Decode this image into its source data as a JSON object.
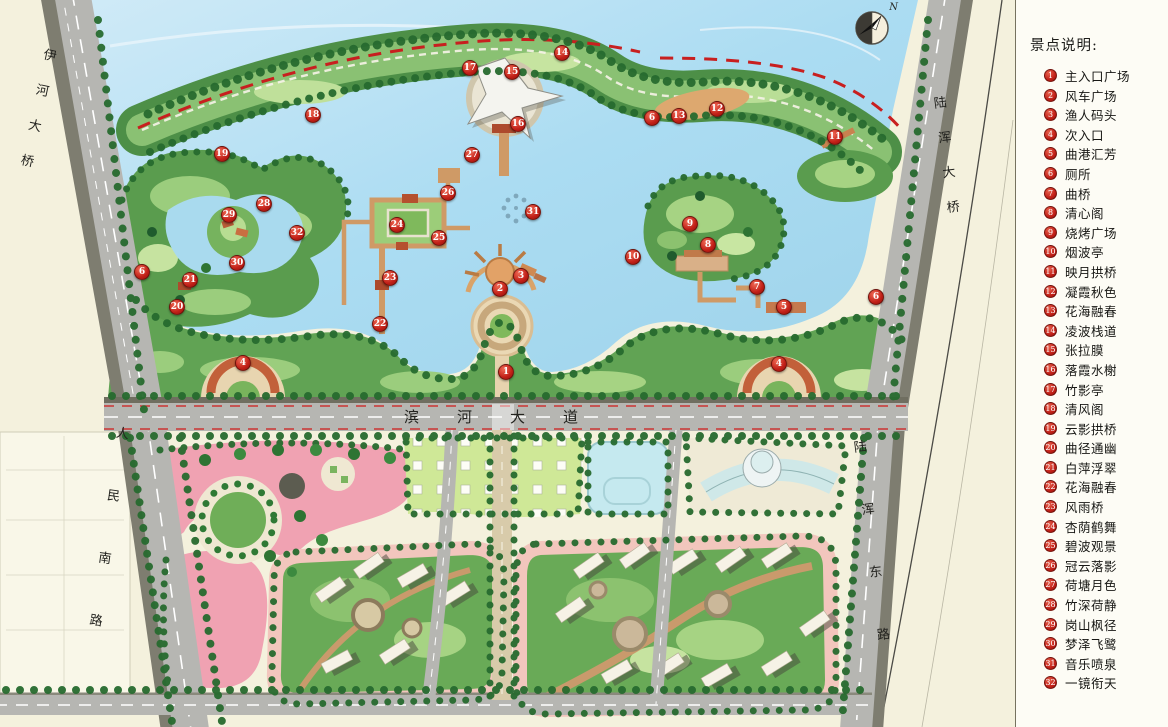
{
  "legend": {
    "title": "景点说明:",
    "items": [
      {
        "n": "1",
        "label": "主入口广场"
      },
      {
        "n": "2",
        "label": "风车广场"
      },
      {
        "n": "3",
        "label": "渔人码头"
      },
      {
        "n": "4",
        "label": "次入口"
      },
      {
        "n": "5",
        "label": "曲港汇芳"
      },
      {
        "n": "6",
        "label": "厕所"
      },
      {
        "n": "7",
        "label": "曲桥"
      },
      {
        "n": "8",
        "label": "清心阁"
      },
      {
        "n": "9",
        "label": "烧烤广场"
      },
      {
        "n": "10",
        "label": "烟波亭"
      },
      {
        "n": "11",
        "label": "映月拱桥"
      },
      {
        "n": "12",
        "label": "凝霞秋色"
      },
      {
        "n": "13",
        "label": "花海融春"
      },
      {
        "n": "14",
        "label": "凌波栈道"
      },
      {
        "n": "15",
        "label": "张拉膜"
      },
      {
        "n": "16",
        "label": "落霞水榭"
      },
      {
        "n": "17",
        "label": "竹影亭"
      },
      {
        "n": "18",
        "label": "清风阁"
      },
      {
        "n": "19",
        "label": "云影拱桥"
      },
      {
        "n": "20",
        "label": "曲径通幽"
      },
      {
        "n": "21",
        "label": "白萍浮翠"
      },
      {
        "n": "22",
        "label": "花海融春"
      },
      {
        "n": "23",
        "label": "风雨桥"
      },
      {
        "n": "24",
        "label": "杏荫鹤舞"
      },
      {
        "n": "25",
        "label": "碧波观景"
      },
      {
        "n": "26",
        "label": "冠云落影"
      },
      {
        "n": "27",
        "label": "荷塘月色"
      },
      {
        "n": "28",
        "label": "竹深荷静"
      },
      {
        "n": "29",
        "label": "岗山枫径"
      },
      {
        "n": "30",
        "label": "梦泽飞鹭"
      },
      {
        "n": "31",
        "label": "音乐喷泉"
      },
      {
        "n": "32",
        "label": "一镜衔天"
      }
    ]
  },
  "roads": {
    "yihe_bridge": "伊河大桥",
    "luhun_bridge": "陆浑大桥",
    "renmin_south_road": "人民南路",
    "binhe_avenue": "滨河大道",
    "luhun_east_road": "陆浑东路"
  },
  "compass": {
    "north_label": "N"
  },
  "map": {
    "markers": [
      {
        "n": "14",
        "x": 562,
        "y": 53
      },
      {
        "n": "17",
        "x": 470,
        "y": 68
      },
      {
        "n": "15",
        "x": 512,
        "y": 72
      },
      {
        "n": "16",
        "x": 518,
        "y": 124
      },
      {
        "n": "27",
        "x": 472,
        "y": 155
      },
      {
        "n": "6",
        "x": 652,
        "y": 118
      },
      {
        "n": "13",
        "x": 679,
        "y": 116
      },
      {
        "n": "12",
        "x": 717,
        "y": 109
      },
      {
        "n": "11",
        "x": 835,
        "y": 137
      },
      {
        "n": "18",
        "x": 313,
        "y": 115
      },
      {
        "n": "19",
        "x": 222,
        "y": 154
      },
      {
        "n": "28",
        "x": 264,
        "y": 204
      },
      {
        "n": "29",
        "x": 229,
        "y": 215
      },
      {
        "n": "32",
        "x": 297,
        "y": 233
      },
      {
        "n": "30",
        "x": 237,
        "y": 263
      },
      {
        "n": "26",
        "x": 448,
        "y": 193
      },
      {
        "n": "24",
        "x": 397,
        "y": 225
      },
      {
        "n": "25",
        "x": 439,
        "y": 238
      },
      {
        "n": "31",
        "x": 533,
        "y": 212
      },
      {
        "n": "23",
        "x": 390,
        "y": 278
      },
      {
        "n": "3",
        "x": 521,
        "y": 276
      },
      {
        "n": "2",
        "x": 500,
        "y": 289
      },
      {
        "n": "22",
        "x": 380,
        "y": 324
      },
      {
        "n": "1",
        "x": 506,
        "y": 372
      },
      {
        "n": "21",
        "x": 190,
        "y": 280
      },
      {
        "n": "20",
        "x": 177,
        "y": 307
      },
      {
        "n": "6",
        "x": 142,
        "y": 272
      },
      {
        "n": "4",
        "x": 243,
        "y": 363
      },
      {
        "n": "9",
        "x": 690,
        "y": 224
      },
      {
        "n": "8",
        "x": 708,
        "y": 245
      },
      {
        "n": "10",
        "x": 633,
        "y": 257
      },
      {
        "n": "7",
        "x": 757,
        "y": 287
      },
      {
        "n": "5",
        "x": 784,
        "y": 307
      },
      {
        "n": "6",
        "x": 876,
        "y": 297
      },
      {
        "n": "4",
        "x": 779,
        "y": 364
      }
    ]
  },
  "colors": {
    "water": "#aadcf0",
    "park_green": "#61a354",
    "building_pink": "#f0a2b2",
    "road_gray": "#b6b6b2",
    "marker_red": "#c01e16",
    "boundary_red": "#c81f1f",
    "background": "#f4f1dd"
  }
}
